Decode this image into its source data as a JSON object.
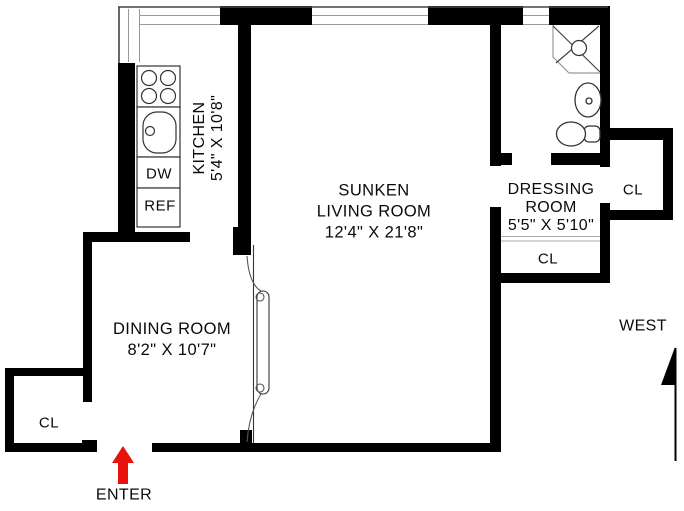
{
  "rooms": {
    "kitchen": {
      "name": "KITCHEN",
      "dims": "5'4\" X 10'8\""
    },
    "living": {
      "line1": "SUNKEN",
      "line2": "LIVING ROOM",
      "dims": "12'4\" X 21'8\""
    },
    "dining": {
      "name": "DINING ROOM",
      "dims": "8'2\" X 10'7\""
    },
    "dressing": {
      "line1": "DRESSING",
      "line2": "ROOM",
      "dims": "5'5\" X 5'10\""
    }
  },
  "closets": {
    "entry_closet": "CL",
    "dressing_closet": "CL",
    "east_closet": "CL"
  },
  "appliances": {
    "dishwasher": "DW",
    "refrigerator": "REF"
  },
  "entry": {
    "label": "ENTER"
  },
  "compass": {
    "label": "WEST"
  },
  "colors": {
    "wall": "#000000",
    "detail_line": "#888888",
    "entry_arrow": "#e8120a",
    "background": "#ffffff"
  }
}
